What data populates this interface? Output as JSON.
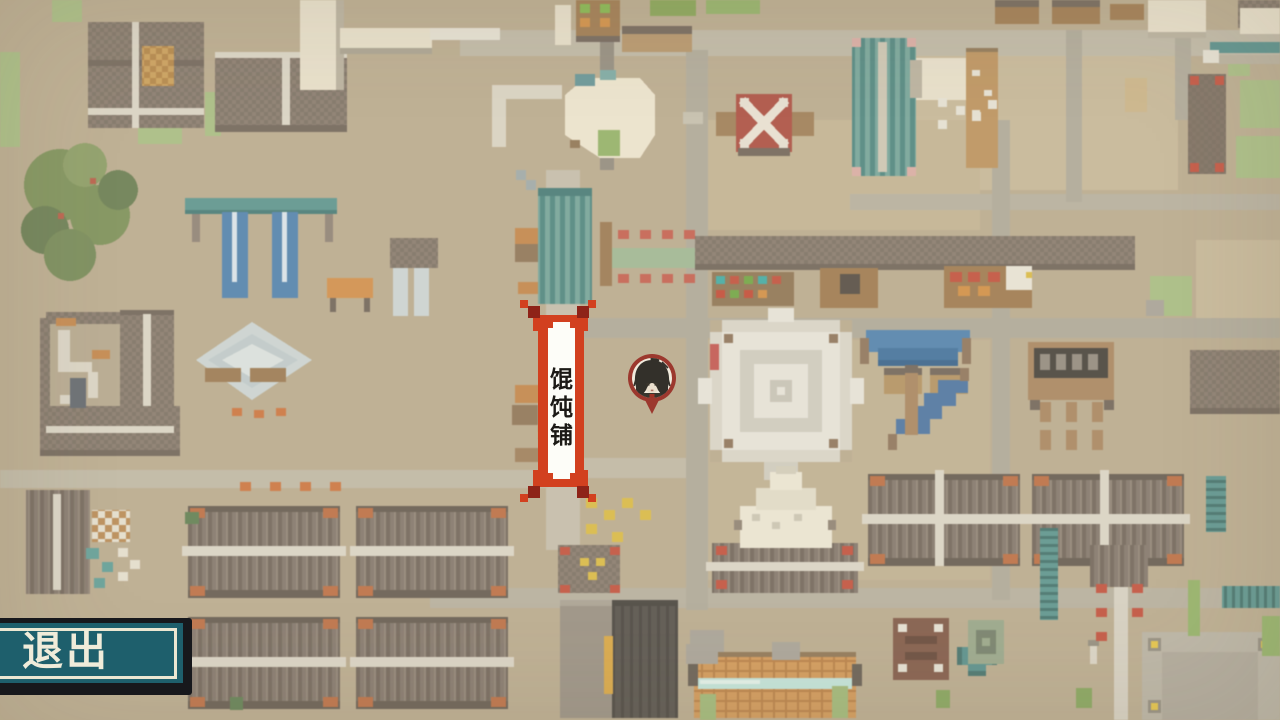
{
  "scene": {
    "type": "pixel-art-town-map"
  },
  "map": {
    "location_banner": {
      "text": "馄饨铺"
    },
    "player_marker": {
      "portrait": "long-dark-hair-character"
    },
    "palette": {
      "ground": "#b7a78a",
      "road": "#aba595",
      "roof": "#7d7065",
      "ridge_white": "#d9d3c4",
      "accent_teal": "#55908a",
      "accent_blue": "#4a7dab",
      "accent_red": "#bf4936",
      "accent_orange": "#c96f38",
      "accent_yellow": "#d8b73e",
      "tree_green": "#768b52",
      "grass_green": "#a4ba7e"
    }
  },
  "hud": {
    "exit_button": {
      "label": "退出",
      "fill": "#1e5f6c",
      "border": "#17181c",
      "inner_line": "#ece7d2",
      "text_color": "#f0ecda"
    }
  },
  "banner_colors": {
    "red": "#d2401f",
    "corner_dark_red": "#8e2318",
    "panel": "#fdfdf8",
    "text": "#1c1a16",
    "marker_ring": "#9c382e"
  }
}
